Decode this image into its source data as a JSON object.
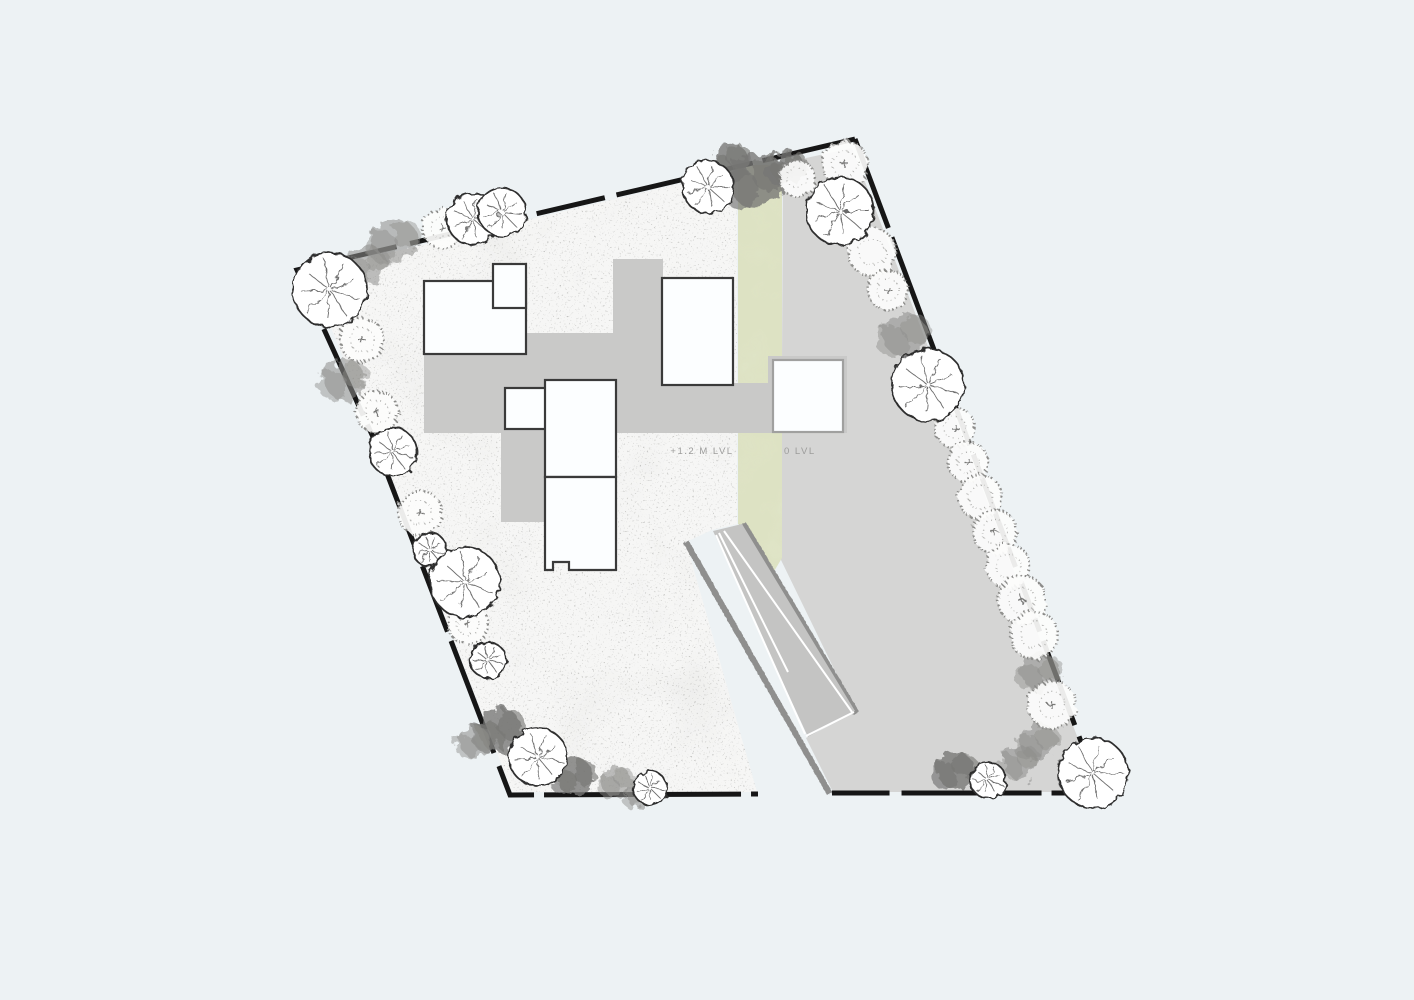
{
  "page": {
    "title": "site-plan",
    "background": "#edf2f4"
  },
  "labels": {
    "garden_level": "+1.2 M LVL",
    "road_level": "0 LVL"
  },
  "colors": {
    "background": "#edf2f4",
    "garden_base": "#f6f6f5",
    "garden_speckle": "#90908d",
    "road": "#d5d5d4",
    "green_strip": "#dde2c3",
    "green_mottle": "#c6cd9e",
    "deck": "#c9c9c8",
    "ramp": "#c4c4c3",
    "ramp_line": "#ffffff",
    "wall": "#8f8f8e",
    "boundary": "#161616",
    "room_fill": "#fcfeff",
    "room_stroke": "#3a3a3a",
    "room_stroke_light": "#a0a09f",
    "tree_outline": "#2e2e2e",
    "tree_spoke": "#6a6a6a",
    "tree_stipple": "#8b8b89",
    "bush": "#8d8d8b",
    "bush_dark": "#767674"
  },
  "site": {
    "garden_poly": "308,272 737,170 737,524 712,530 686,542 757,792 512,792 376,437",
    "road_poly": "783,163 852,148 1090,770 1086,792 833,792 806,738 855,712 781,560",
    "green_poly": "738,165 782,165 782,558 770,578 743,527 738,524",
    "boundary_left": "855,139 297,270 373,437 510,795 758,794",
    "boundary_right": "855,139 1092,771 1087,793 832,793",
    "boundary_dash": "95 10 140 12 70 10 120 14 55 10 90 12",
    "walls": [
      {
        "x1": 738.5,
        "y1": 160,
        "x2": 738.5,
        "y2": 524,
        "w": 7
      },
      {
        "x1": 743,
        "y1": 524,
        "x2": 856,
        "y2": 713,
        "w": 7
      },
      {
        "x1": 686,
        "y1": 542,
        "x2": 830,
        "y2": 794,
        "w": 6
      }
    ],
    "ramp": {
      "surface": "713,531 742,524 855,711 808,737",
      "lines": [
        "716,535 805,734",
        "724,531 852,712",
        "719,533 788,672",
        "806,736 854,712"
      ]
    },
    "deck": [
      {
        "x": 613,
        "y": 259,
        "w": 50,
        "h": 174
      },
      {
        "x": 526,
        "y": 333,
        "w": 90,
        "h": 100
      },
      {
        "x": 424,
        "y": 354,
        "w": 192,
        "h": 79
      },
      {
        "x": 616,
        "y": 383,
        "w": 231,
        "h": 50
      },
      {
        "x": 768,
        "y": 356,
        "w": 79,
        "h": 77
      },
      {
        "x": 501,
        "y": 433,
        "w": 45,
        "h": 89
      }
    ],
    "rooms": [
      {
        "x": 424,
        "y": 281,
        "w": 102,
        "h": 73
      },
      {
        "x": 493,
        "y": 264,
        "w": 33,
        "h": 44
      },
      {
        "x": 505,
        "y": 388,
        "w": 41,
        "h": 41
      },
      {
        "x": 545,
        "y": 380,
        "w": 71,
        "h": 97
      },
      {
        "path": "M545,477 L616,477 L616,570 L569,570 L569,562 L553,562 L553,570 L545,570 Z"
      },
      {
        "x": 662,
        "y": 278,
        "w": 71,
        "h": 107
      },
      {
        "x": 773,
        "y": 360,
        "w": 70,
        "h": 72,
        "light": true
      }
    ],
    "label_positions": {
      "garden_level": {
        "x": 702,
        "y": 454,
        "anchor": "middle"
      },
      "road_level": {
        "x": 784,
        "y": 454,
        "anchor": "start"
      }
    }
  },
  "trees": [
    {
      "t": "b",
      "x": 368,
      "y": 265,
      "r": 22
    },
    {
      "t": "b",
      "x": 345,
      "y": 380,
      "r": 24
    },
    {
      "t": "b",
      "x": 395,
      "y": 240,
      "r": 26
    },
    {
      "t": "b",
      "x": 730,
      "y": 162,
      "r": 22,
      "k": "dark"
    },
    {
      "t": "b",
      "x": 755,
      "y": 180,
      "r": 32,
      "k": "dark"
    },
    {
      "t": "b",
      "x": 788,
      "y": 168,
      "r": 20,
      "k": "dark"
    },
    {
      "t": "b",
      "x": 905,
      "y": 335,
      "r": 26
    },
    {
      "t": "b",
      "x": 1040,
      "y": 672,
      "r": 22
    },
    {
      "t": "b",
      "x": 1038,
      "y": 742,
      "r": 22
    },
    {
      "t": "b",
      "x": 1020,
      "y": 762,
      "r": 20
    },
    {
      "t": "b",
      "x": 955,
      "y": 770,
      "r": 22,
      "k": "dark"
    },
    {
      "t": "b",
      "x": 500,
      "y": 730,
      "r": 26,
      "k": "dark"
    },
    {
      "t": "b",
      "x": 475,
      "y": 742,
      "r": 18
    },
    {
      "t": "b",
      "x": 575,
      "y": 777,
      "r": 22,
      "k": "dark"
    },
    {
      "t": "b",
      "x": 617,
      "y": 782,
      "r": 18
    },
    {
      "t": "b",
      "x": 640,
      "y": 795,
      "r": 16
    },
    {
      "t": "s",
      "x": 362,
      "y": 340,
      "r": 22,
      "c": true
    },
    {
      "t": "s",
      "x": 442,
      "y": 228,
      "r": 20,
      "c": true
    },
    {
      "t": "s",
      "x": 797,
      "y": 178,
      "r": 18
    },
    {
      "t": "s",
      "x": 845,
      "y": 164,
      "r": 23,
      "c": true
    },
    {
      "t": "s",
      "x": 872,
      "y": 252,
      "r": 24
    },
    {
      "t": "s",
      "x": 888,
      "y": 290,
      "r": 20,
      "c": true
    },
    {
      "t": "s",
      "x": 955,
      "y": 428,
      "r": 20,
      "c": true
    },
    {
      "t": "s",
      "x": 968,
      "y": 462,
      "r": 20,
      "c": true
    },
    {
      "t": "s",
      "x": 980,
      "y": 497,
      "r": 22
    },
    {
      "t": "s",
      "x": 995,
      "y": 532,
      "r": 22,
      "c": true
    },
    {
      "t": "s",
      "x": 1008,
      "y": 566,
      "r": 22
    },
    {
      "t": "s",
      "x": 1022,
      "y": 600,
      "r": 24,
      "c": true
    },
    {
      "t": "s",
      "x": 1034,
      "y": 635,
      "r": 24
    },
    {
      "t": "s",
      "x": 1052,
      "y": 705,
      "r": 24,
      "c": true
    },
    {
      "t": "s",
      "x": 377,
      "y": 412,
      "r": 21,
      "c": true
    },
    {
      "t": "s",
      "x": 420,
      "y": 513,
      "r": 22,
      "c": true
    },
    {
      "t": "s",
      "x": 468,
      "y": 624,
      "r": 20,
      "c": true
    },
    {
      "t": "o",
      "x": 330,
      "y": 290,
      "r": 37
    },
    {
      "t": "o",
      "x": 473,
      "y": 219,
      "r": 26
    },
    {
      "t": "o",
      "x": 502,
      "y": 212,
      "r": 24
    },
    {
      "t": "o",
      "x": 708,
      "y": 187,
      "r": 26
    },
    {
      "t": "o",
      "x": 840,
      "y": 211,
      "r": 34
    },
    {
      "t": "o",
      "x": 928,
      "y": 385,
      "r": 36
    },
    {
      "t": "o",
      "x": 1093,
      "y": 773,
      "r": 35
    },
    {
      "t": "o",
      "x": 988,
      "y": 780,
      "r": 18
    },
    {
      "t": "o",
      "x": 393,
      "y": 452,
      "r": 24
    },
    {
      "t": "o",
      "x": 430,
      "y": 550,
      "r": 17
    },
    {
      "t": "o",
      "x": 465,
      "y": 582,
      "r": 35
    },
    {
      "t": "o",
      "x": 488,
      "y": 660,
      "r": 18
    },
    {
      "t": "o",
      "x": 538,
      "y": 757,
      "r": 29
    },
    {
      "t": "o",
      "x": 650,
      "y": 788,
      "r": 17
    }
  ]
}
